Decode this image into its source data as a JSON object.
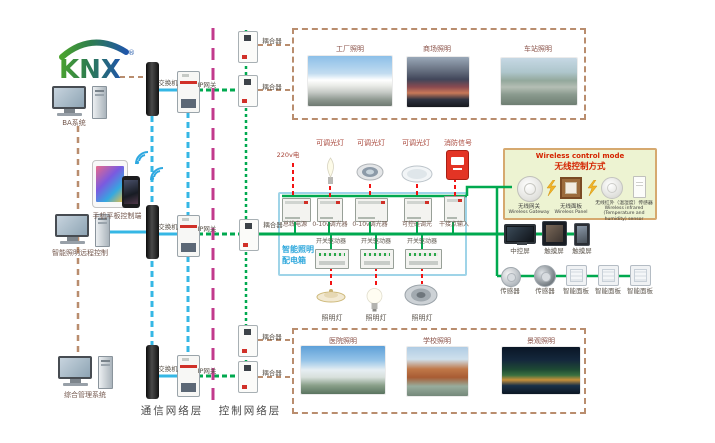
{
  "logo": {
    "text": "KNX",
    "reg": "®"
  },
  "left": {
    "computers": [
      {
        "label": "BA系统"
      },
      {
        "label": "智能照明远程控制"
      },
      {
        "label": "综合管理系统"
      }
    ],
    "mobile": {
      "label": "手机平板控制端"
    }
  },
  "network": {
    "rows": [
      {
        "switch": "交换机",
        "gateway": "IP网关"
      },
      {
        "switch": "交换机",
        "gateway": "IP网关"
      },
      {
        "switch": "交换机",
        "gateway": "IP网关"
      }
    ],
    "couplers": [
      "耦合器",
      "耦合器",
      "耦合器",
      "耦合器",
      "耦合器"
    ],
    "layer_labels": {
      "communication": "通信网络层",
      "control": "控制网络层"
    }
  },
  "distribution_box": {
    "title_line1": "智能照明",
    "title_line2": "配电箱",
    "power_input": "220v电",
    "lamp_labels": [
      "可调光灯",
      "可调光灯",
      "可调光灯"
    ],
    "fire_label": "消防信号",
    "module_labels": [
      "总线电源",
      "0-10v调光器",
      "0-10v调光器",
      "可控硅调光",
      "干接点输入"
    ],
    "driver_labels": [
      "开关驱动器",
      "开关驱动器",
      "开关驱动器"
    ],
    "output_lamp_labels": [
      "照明灯",
      "照明灯",
      "照明灯"
    ]
  },
  "wireless": {
    "title_en": "Wireless control mode",
    "title_cn": "无线控制方式",
    "items": [
      {
        "cn": "无线网关",
        "en": "Wireless Gateway"
      },
      {
        "cn": "无线面板",
        "en": "Wireless Panel"
      },
      {
        "cn": "无线红外（温湿度）传感器",
        "en": "Wireless infrared (Temperature and humidity) sensor"
      }
    ]
  },
  "control_devices": {
    "screens": [
      {
        "label": "中控屏"
      },
      {
        "label": "触摸屏"
      },
      {
        "label": "触摸屏"
      }
    ],
    "sensors_panels": [
      {
        "label": "传感器"
      },
      {
        "label": "传感器"
      },
      {
        "label": "智能面板"
      },
      {
        "label": "智能面板"
      },
      {
        "label": "智能面板"
      }
    ]
  },
  "scenes": {
    "top": [
      {
        "label": "工厂照明"
      },
      {
        "label": "商场照明"
      },
      {
        "label": "车站照明"
      }
    ],
    "bottom": [
      {
        "label": "医院照明"
      },
      {
        "label": "学校照明"
      },
      {
        "label": "景观照明"
      }
    ]
  },
  "colors": {
    "blue_line": "#35b7e5",
    "green_line": "#00a94f",
    "magenta_line": "#c23a8c",
    "tan_line": "#b98d6e",
    "red_line": "#f21313",
    "box_border": "#9fd4e8",
    "wireless_bg": "#edf3d2"
  }
}
